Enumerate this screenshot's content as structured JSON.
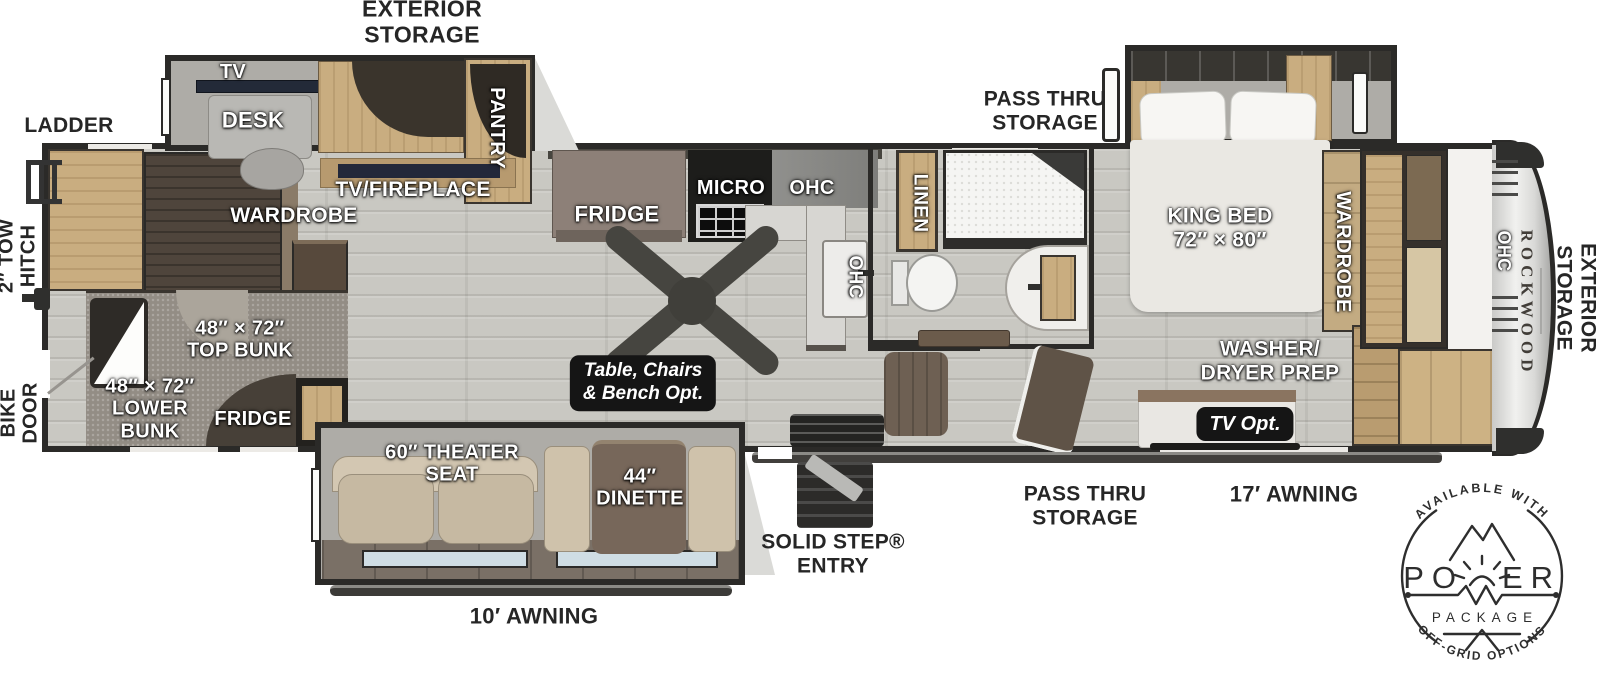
{
  "plan": {
    "brand": "ROCKWOOD",
    "exterior": {
      "storage_top": "EXTERIOR\nSTORAGE",
      "storage_front": "EXTERIOR\nSTORAGE",
      "ladder": "LADDER",
      "tow_hitch": "2″ TOW\nHITCH",
      "bike_door": "BIKE\nDOOR",
      "awning_rear": "10′ AWNING",
      "awning_main": "17′ AWNING",
      "entry": "SOLID STEP®\nENTRY",
      "pass_thru_front": "PASS THRU\nSTORAGE",
      "pass_thru_mid": "PASS THRU\nSTORAGE"
    },
    "rear_room": {
      "tv": "TV",
      "desk": "DESK",
      "pantry": "PANTRY",
      "tv_fireplace": "TV/FIREPLACE",
      "wardrobe": "WARDROBE",
      "top_bunk": "48″ × 72″\nTOP BUNK",
      "lower_bunk": "48″ × 72″\nLOWER\nBUNK",
      "fridge": "FRIDGE"
    },
    "kitchen": {
      "fridge": "FRIDGE",
      "micro": "MICRO",
      "ohc_top": "OHC",
      "ohc_side": "OHC",
      "table_option": "Table, Chairs\n& Bench Opt."
    },
    "living": {
      "theater_seat": "60″ THEATER\nSEAT",
      "dinette": "44″\nDINETTE"
    },
    "bath": {
      "linen": "LINEN"
    },
    "bedroom": {
      "king_bed": "KING BED\n72″ × 80″",
      "wardrobe": "WARDROBE",
      "washer_dryer": "WASHER/\nDRYER PREP",
      "tv_opt": "TV Opt.",
      "ohc_front": "OHC"
    }
  },
  "badge": {
    "available_with": "AVAILABLE WITH",
    "power_prefix": "PO",
    "power_suffix": "ER",
    "package": "PACKAGE",
    "off_grid": "OFF-GRID OPTIONS"
  },
  "colors": {
    "wall": "#2b2a28",
    "floor": "#c9c8c2",
    "wood": "#c9ad80",
    "badge_ink": "#2e2e2e"
  }
}
